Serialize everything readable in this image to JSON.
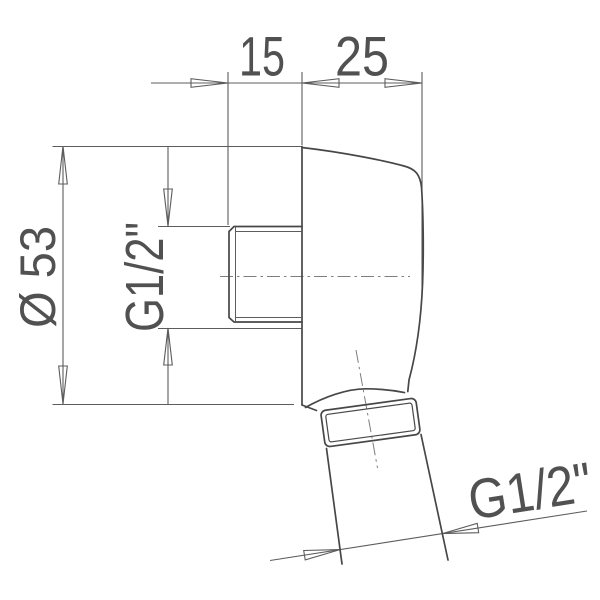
{
  "drawing": {
    "labels": {
      "top_left_dim": "15",
      "top_right_dim": "25",
      "diameter_dim": "Ø 53",
      "wall_thread_dim": "G1/2\"",
      "outlet_thread_dim": "G1/2\""
    },
    "colors": {
      "background": "#ffffff",
      "outline": "#474747",
      "dimension": "#5c5c5c",
      "centerline": "#7e7e7e",
      "text": "#515151"
    }
  }
}
